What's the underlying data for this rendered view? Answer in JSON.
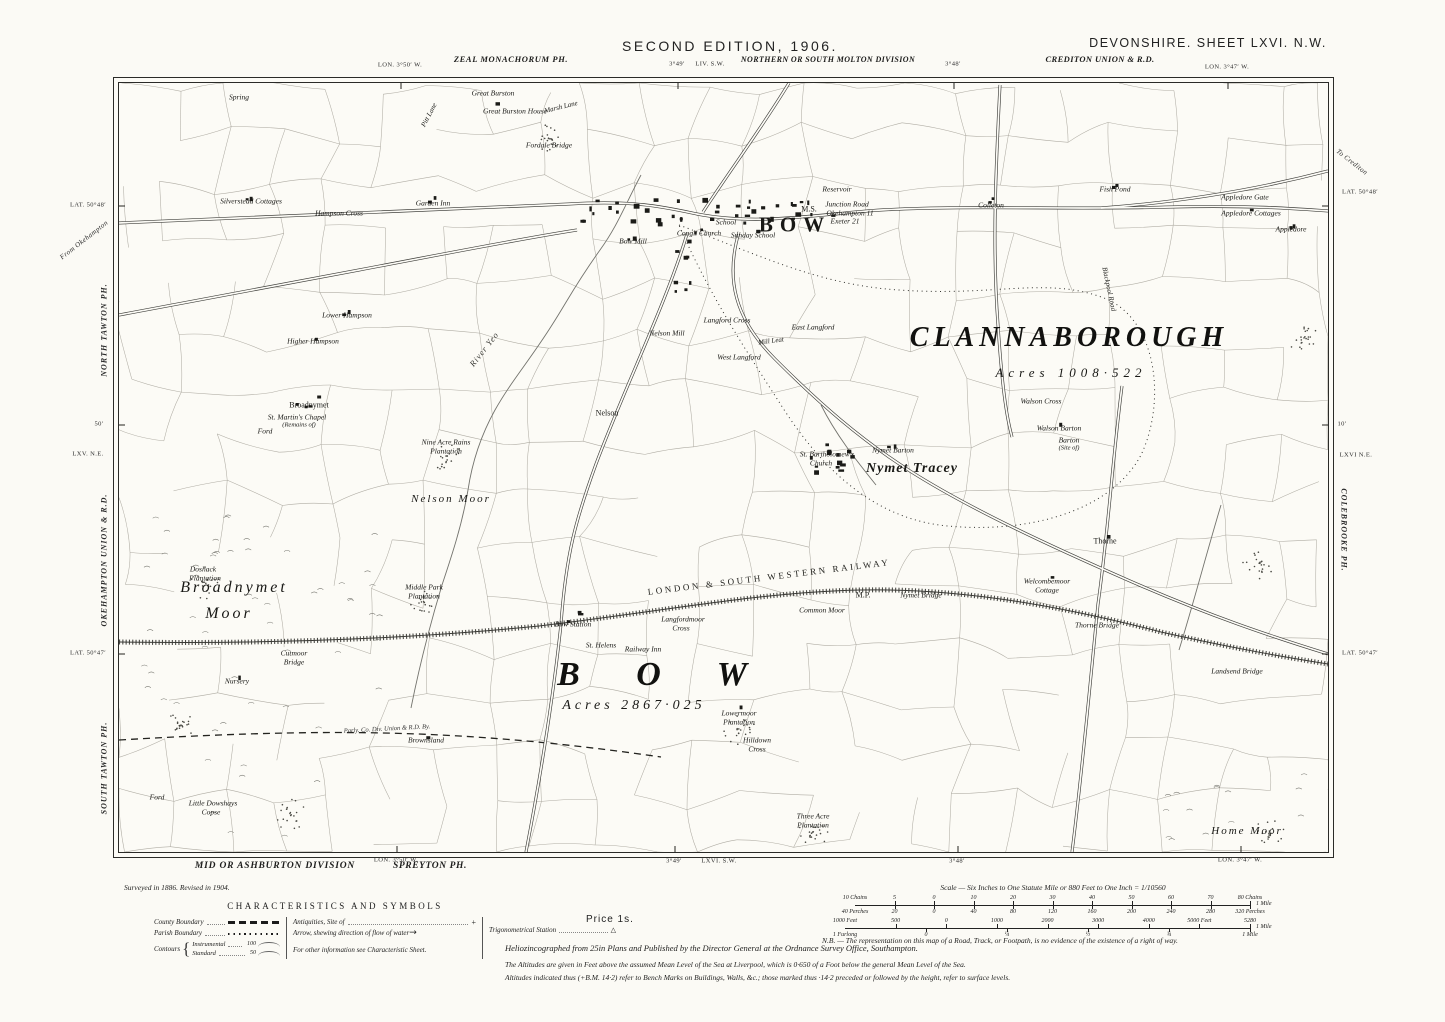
{
  "colors": {
    "paper": "#fbfaf5",
    "ink": "#1d1d1c",
    "faint_line": "#a29f95"
  },
  "header": {
    "edition": "SECOND EDITION, 1906.",
    "sheet": "DEVONSHIRE. SHEET LXVI. N.W.",
    "parish_top": "ZEAL MONACHORUM PH.",
    "division_top": "NORTHERN OR SOUTH MOLTON DIVISION",
    "union_top": "CREDITON UNION & R.D."
  },
  "margins": {
    "top": [
      {
        "text": "LON. 3°50′ W.",
        "x": 400,
        "y": 65
      },
      {
        "text": "3°49′",
        "x": 677,
        "y": 64
      },
      {
        "text": "LIV. S.W.",
        "x": 710,
        "y": 64
      },
      {
        "text": "3°48′",
        "x": 953,
        "y": 64
      },
      {
        "text": "LON. 3°47′ W.",
        "x": 1227,
        "y": 67
      }
    ],
    "bottom": [
      {
        "text": "LON. 3°50′ W.",
        "x": 396,
        "y": 860
      },
      {
        "text": "3°49′",
        "x": 674,
        "y": 861
      },
      {
        "text": "LXVI. S.W.",
        "x": 719,
        "y": 861
      },
      {
        "text": "3°48′",
        "x": 957,
        "y": 861
      },
      {
        "text": "LON. 3°47′ W.",
        "x": 1240,
        "y": 860
      }
    ],
    "left": [
      {
        "text": "LAT. 50°48′",
        "x": 88,
        "y": 205
      },
      {
        "text": "From Okehampton",
        "x": 84,
        "y": 240,
        "rot": -38,
        "cls": "m-italic"
      },
      {
        "text": "NORTH TAWTON PH.",
        "x": 104,
        "y": 330,
        "rot": -90,
        "cls": "m-rot"
      },
      {
        "text": "50′",
        "x": 99,
        "y": 424
      },
      {
        "text": "LXV. N.E.",
        "x": 88,
        "y": 454
      },
      {
        "text": "OKEHAMPTON UNION & R.D.",
        "x": 104,
        "y": 560,
        "rot": -90,
        "cls": "m-rot"
      },
      {
        "text": "LAT. 50°47′",
        "x": 88,
        "y": 653
      },
      {
        "text": "SOUTH TAWTON PH.",
        "x": 104,
        "y": 768,
        "rot": -90,
        "cls": "m-rot"
      }
    ],
    "right": [
      {
        "text": "To Crediton",
        "x": 1352,
        "y": 162,
        "rot": 38,
        "cls": "m-italic"
      },
      {
        "text": "LAT. 50°48′",
        "x": 1360,
        "y": 192
      },
      {
        "text": "10′",
        "x": 1342,
        "y": 424
      },
      {
        "text": "LXVI N.E.",
        "x": 1356,
        "y": 455
      },
      {
        "text": "COLEBROOKE PH.",
        "x": 1344,
        "y": 530,
        "rot": 90,
        "cls": "m-rot"
      },
      {
        "text": "LAT. 50°47′",
        "x": 1360,
        "y": 653
      }
    ]
  },
  "map": {
    "labels": [
      {
        "t": "BOW",
        "x": 676,
        "y": 142,
        "c": "town"
      },
      {
        "t": "CLANNABOROUGH",
        "x": 950,
        "y": 255,
        "c": "parishbig"
      },
      {
        "t": "Acres 1008·522",
        "x": 952,
        "y": 290,
        "c": "acres"
      },
      {
        "t": "B O W",
        "x": 545,
        "y": 592,
        "c": "parishhuge"
      },
      {
        "t": "Acres 2867·025",
        "x": 515,
        "y": 623,
        "c": "acres2"
      },
      {
        "t": "Nymet Tracey",
        "x": 793,
        "y": 386,
        "c": "village"
      },
      {
        "t": "LONDON & SOUTH WESTERN RAILWAY",
        "x": 650,
        "y": 494,
        "c": "railway",
        "r": -7
      },
      {
        "t": "Broadnymet",
        "x": 115,
        "y": 505,
        "c": "moor"
      },
      {
        "t": "Moor",
        "x": 110,
        "y": 531,
        "c": "moor"
      },
      {
        "t": "Nelson Moor",
        "x": 332,
        "y": 416,
        "c": "moorsm"
      },
      {
        "t": "Home Moor",
        "x": 1128,
        "y": 748,
        "c": "moorsm"
      },
      {
        "t": "Common Moor",
        "x": 703,
        "y": 527,
        "c": "tiny"
      },
      {
        "t": "Broadnymet",
        "x": 190,
        "y": 322,
        "c": "name"
      },
      {
        "t": "St. Martin's Chapel",
        "x": 178,
        "y": 334,
        "c": "tiny"
      },
      {
        "t": "(Remains of)",
        "x": 180,
        "y": 342,
        "c": "remains"
      },
      {
        "t": "Ford",
        "x": 146,
        "y": 348,
        "c": "tiny"
      },
      {
        "t": "Nelson",
        "x": 488,
        "y": 330,
        "c": "name"
      },
      {
        "t": "Thorne",
        "x": 986,
        "y": 458,
        "c": "name"
      },
      {
        "t": "Spring",
        "x": 120,
        "y": 14,
        "c": "tiny"
      },
      {
        "t": "Great Burston",
        "x": 374,
        "y": 10,
        "c": "tiny"
      },
      {
        "t": "Great Burston House",
        "x": 396,
        "y": 28,
        "c": "tiny"
      },
      {
        "t": "Pitt Lane",
        "x": 310,
        "y": 32,
        "c": "lane",
        "r": -62
      },
      {
        "t": "Marsh Lane",
        "x": 442,
        "y": 24,
        "c": "lane",
        "r": -14
      },
      {
        "t": "Fordale Bridge",
        "x": 430,
        "y": 62,
        "c": "tiny"
      },
      {
        "t": "Silverstead Cottages",
        "x": 132,
        "y": 118,
        "c": "tiny"
      },
      {
        "t": "Hampson Cross",
        "x": 220,
        "y": 130,
        "c": "tiny"
      },
      {
        "t": "Garden Inn",
        "x": 314,
        "y": 120,
        "c": "tiny"
      },
      {
        "t": "Lower Hampson",
        "x": 228,
        "y": 232,
        "c": "tiny"
      },
      {
        "t": "Higher Hampson",
        "x": 194,
        "y": 258,
        "c": "tiny"
      },
      {
        "t": "Bow Mill",
        "x": 514,
        "y": 158,
        "c": "tiny"
      },
      {
        "t": "Congl. Church",
        "x": 580,
        "y": 150,
        "c": "tiny"
      },
      {
        "t": "School",
        "x": 607,
        "y": 139,
        "c": "tiny"
      },
      {
        "t": "Sunday School",
        "x": 634,
        "y": 152,
        "c": "tiny"
      },
      {
        "t": "Reservoir",
        "x": 718,
        "y": 106,
        "c": "tiny"
      },
      {
        "t": "M.S.",
        "x": 690,
        "y": 126,
        "c": "name"
      },
      {
        "t": "Junction Road",
        "x": 728,
        "y": 121,
        "c": "tiny"
      },
      {
        "t": "Okehampton 11",
        "x": 731,
        "y": 130,
        "c": "tiny"
      },
      {
        "t": "Exeter 21",
        "x": 726,
        "y": 138,
        "c": "tiny"
      },
      {
        "t": "Colleton",
        "x": 872,
        "y": 122,
        "c": "tiny"
      },
      {
        "t": "Fish Pond",
        "x": 996,
        "y": 106,
        "c": "tiny"
      },
      {
        "t": "Appledore Gate",
        "x": 1126,
        "y": 114,
        "c": "tiny"
      },
      {
        "t": "Appledore Cottages",
        "x": 1132,
        "y": 130,
        "c": "tiny"
      },
      {
        "t": "Appledore",
        "x": 1172,
        "y": 146,
        "c": "tiny"
      },
      {
        "t": "Blackpool Road",
        "x": 990,
        "y": 206,
        "c": "lane",
        "r": 78
      },
      {
        "t": "Langford Cross",
        "x": 608,
        "y": 237,
        "c": "tiny"
      },
      {
        "t": "East Langford",
        "x": 694,
        "y": 244,
        "c": "tiny"
      },
      {
        "t": "West Langford",
        "x": 620,
        "y": 274,
        "c": "tiny"
      },
      {
        "t": "Mill Leat",
        "x": 652,
        "y": 258,
        "c": "lane",
        "r": -8
      },
      {
        "t": "Nelson Mill",
        "x": 548,
        "y": 250,
        "c": "tiny"
      },
      {
        "t": "River Yeo",
        "x": 365,
        "y": 266,
        "c": "river",
        "r": -52
      },
      {
        "t": "Nine Acre Rains",
        "x": 327,
        "y": 359,
        "c": "tiny"
      },
      {
        "t": "Plantation",
        "x": 327,
        "y": 368,
        "c": "tiny"
      },
      {
        "t": "Walson Cross",
        "x": 922,
        "y": 318,
        "c": "tiny"
      },
      {
        "t": "Walson Barton",
        "x": 940,
        "y": 345,
        "c": "tiny"
      },
      {
        "t": "Barton",
        "x": 950,
        "y": 357,
        "c": "tiny"
      },
      {
        "t": "(Site of)",
        "x": 950,
        "y": 365,
        "c": "remains"
      },
      {
        "t": "St. Bartholomew's",
        "x": 708,
        "y": 371,
        "c": "tiny"
      },
      {
        "t": "Church",
        "x": 702,
        "y": 380,
        "c": "tiny"
      },
      {
        "t": "Nymet Barton",
        "x": 774,
        "y": 367,
        "c": "tiny"
      },
      {
        "t": "Doshack",
        "x": 84,
        "y": 486,
        "c": "tiny"
      },
      {
        "t": "Plantation",
        "x": 86,
        "y": 495,
        "c": "tiny"
      },
      {
        "t": "Middle Park",
        "x": 305,
        "y": 504,
        "c": "tiny"
      },
      {
        "t": "Plantation",
        "x": 305,
        "y": 513,
        "c": "tiny"
      },
      {
        "t": "Bow Station",
        "x": 454,
        "y": 541,
        "c": "tiny"
      },
      {
        "t": "St. Helens",
        "x": 482,
        "y": 562,
        "c": "tiny"
      },
      {
        "t": "Railway Inn",
        "x": 524,
        "y": 566,
        "c": "tiny"
      },
      {
        "t": "Langfordmoor",
        "x": 564,
        "y": 536,
        "c": "tiny"
      },
      {
        "t": "Cross",
        "x": 562,
        "y": 545,
        "c": "tiny"
      },
      {
        "t": "M.P.",
        "x": 744,
        "y": 512,
        "c": "name"
      },
      {
        "t": "Nymet Bridge",
        "x": 802,
        "y": 512,
        "c": "tiny"
      },
      {
        "t": "Welcombemoor",
        "x": 928,
        "y": 498,
        "c": "tiny"
      },
      {
        "t": "Cottage",
        "x": 928,
        "y": 507,
        "c": "tiny"
      },
      {
        "t": "Thorne Bridge",
        "x": 978,
        "y": 542,
        "c": "tiny"
      },
      {
        "t": "Landsend Bridge",
        "x": 1118,
        "y": 588,
        "c": "tiny"
      },
      {
        "t": "Cutmoor",
        "x": 175,
        "y": 570,
        "c": "tiny"
      },
      {
        "t": "Bridge",
        "x": 175,
        "y": 579,
        "c": "tiny"
      },
      {
        "t": "Nursery",
        "x": 118,
        "y": 598,
        "c": "tiny"
      },
      {
        "t": "Parly. Co. Div. Union & R.D. By.",
        "x": 268,
        "y": 646,
        "c": "boundarytxt",
        "r": -3
      },
      {
        "t": "Brownsland",
        "x": 307,
        "y": 657,
        "c": "tiny"
      },
      {
        "t": "Lowermoor",
        "x": 620,
        "y": 630,
        "c": "tiny"
      },
      {
        "t": "Plantation",
        "x": 620,
        "y": 639,
        "c": "tiny"
      },
      {
        "t": "Hilldown",
        "x": 638,
        "y": 657,
        "c": "tiny"
      },
      {
        "t": "Cross",
        "x": 638,
        "y": 666,
        "c": "tiny"
      },
      {
        "t": "Three Acre",
        "x": 694,
        "y": 733,
        "c": "tiny"
      },
      {
        "t": "Plantation",
        "x": 694,
        "y": 742,
        "c": "tiny"
      },
      {
        "t": "Little Dowshays",
        "x": 94,
        "y": 720,
        "c": "tiny"
      },
      {
        "t": "Copse",
        "x": 92,
        "y": 729,
        "c": "tiny"
      },
      {
        "t": "Ford",
        "x": 38,
        "y": 714,
        "c": "tiny"
      }
    ]
  },
  "legend": {
    "title": "CHARACTERISTICS AND SYMBOLS",
    "county": "County Boundary",
    "parish": "Parish Boundary",
    "contours": "Contours",
    "instrumental": "Instrumental",
    "instrumental_value": "100",
    "standard": "Standard",
    "standard_value": "50",
    "antiquities": "Antiquities, Site of",
    "antiquities_symbol": "+",
    "arrow": "Arrow, shewing direction of flow of water",
    "arrow_symbol": "→",
    "trig": "Trigonometrical Station",
    "trig_symbol": "△",
    "other_info": "For other information see Characteristic Sheet.",
    "price": "Price 1s."
  },
  "scale": {
    "caption": "Scale — Six Inches to One Statute Mile or 880 Feet to One Inch = 1/10560",
    "bar1_top": [
      "10 Chains",
      "5",
      "0",
      "10",
      "20",
      "30",
      "40",
      "50",
      "60",
      "70",
      "80 Chains"
    ],
    "bar1_bottom": [
      "40 Perches",
      "20",
      "0",
      "40",
      "80",
      "120",
      "160",
      "200",
      "240",
      "280",
      "320 Perches"
    ],
    "bar1_right": "1 Mile",
    "bar2_top": [
      "1000 Feet",
      "500",
      "0",
      "1000",
      "2000",
      "3000",
      "4000",
      "5000 Feet",
      "5280"
    ],
    "bar2_bottom": [
      "1 Furlong",
      "0",
      "¼",
      "½",
      "¾",
      "1 Mile"
    ],
    "bar2_right": "1 Mile"
  },
  "notes": {
    "surveyed": "Surveyed in 1886.   Revised in 1904.",
    "division_bottom": "MID OR ASHBURTON DIVISION",
    "parish_bottom": "SPREYTON PH.",
    "imprint": "Heliozincographed from 25in Plans and Published by the Director General at the Ordnance Survey Office, Southampton.",
    "nb": "N.B. — The representation on this map of a Road, Track, or Footpath, is no evidence of the existence of a right of way.",
    "altitude1": "The Altitudes are given in Feet above the assumed Mean Level of the Sea at Liverpool, which is 0·650 of a Foot below the general Mean Level of the Sea.",
    "altitude2": "Altitudes indicated thus (+B.M. 14·2) refer to Bench Marks on Buildings, Walls, &c.; those marked thus ·14·2 preceded or followed by the height, refer to surface levels."
  }
}
